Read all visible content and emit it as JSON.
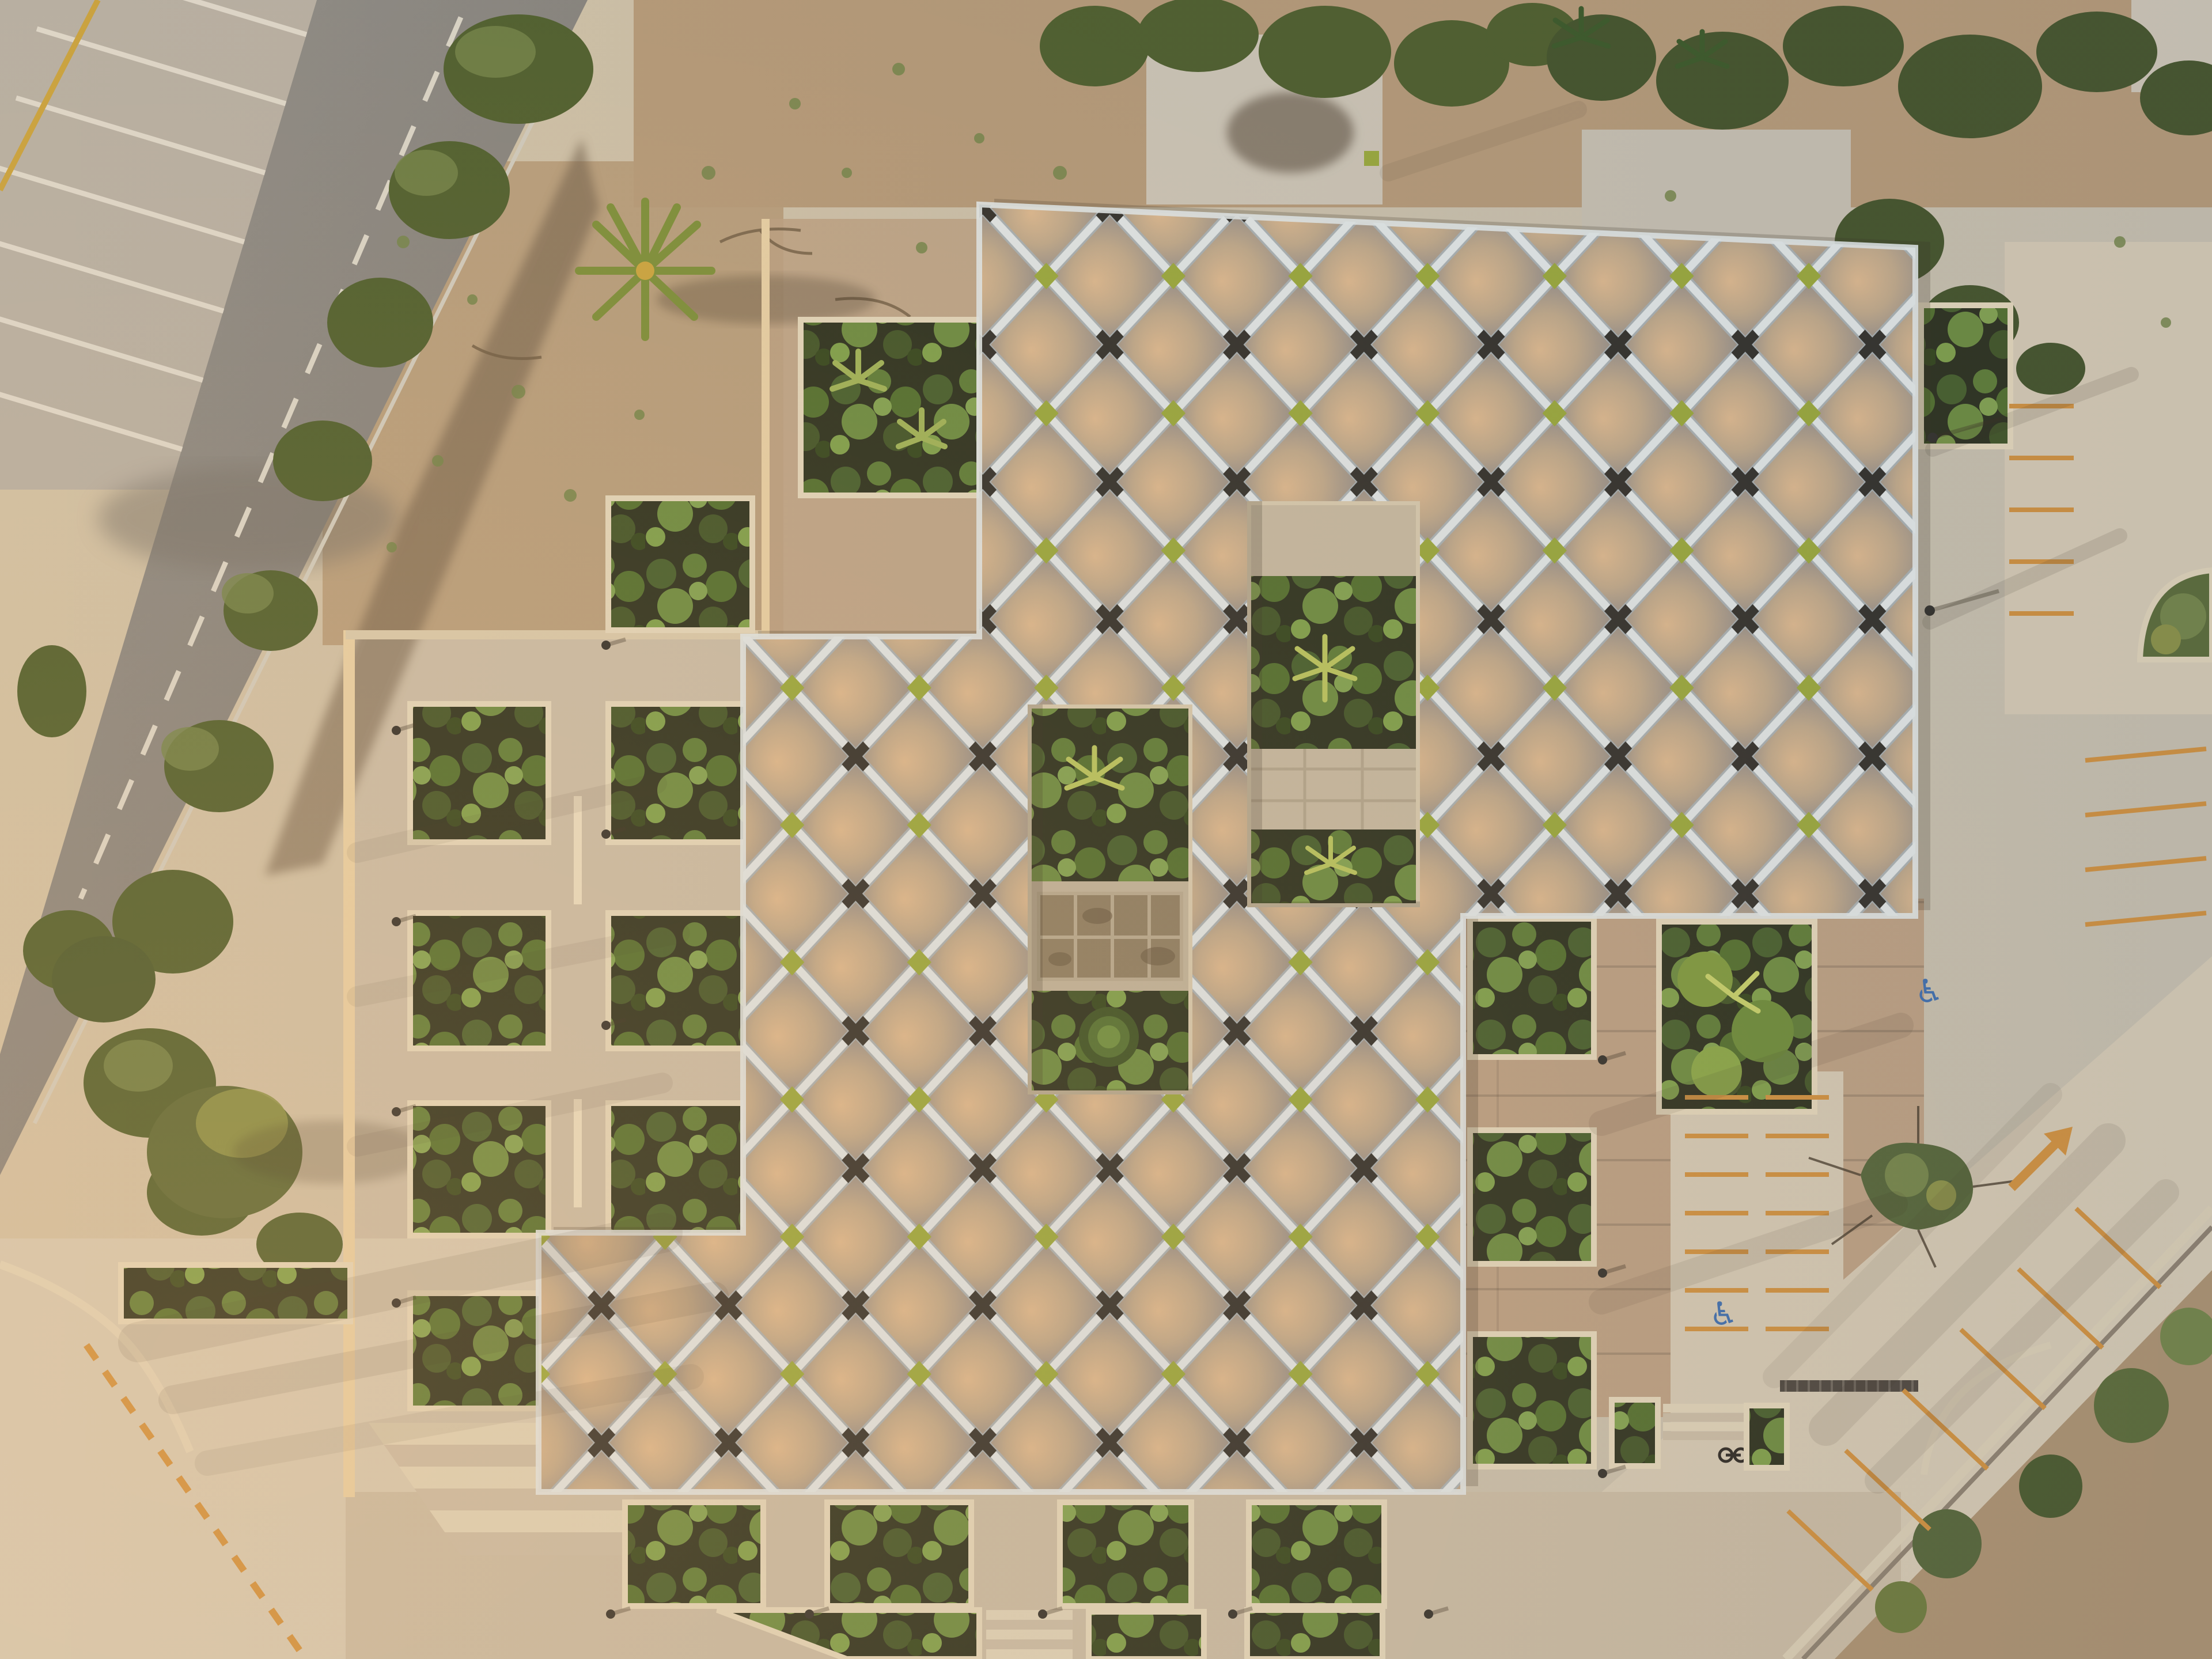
{
  "scene": {
    "type": "aerial-photograph",
    "time_of_day": "golden hour, low sun from west",
    "subject": "building with quilted diamond-grid fabric roof surrounded by courtyard gardens, planter-grid plazas, road and parking lots",
    "building": {
      "roof_blocks": 3,
      "courtyard_openings": 2,
      "roof_texture": "tufted pillow diamonds with pale ribs",
      "node_style": "dark X clips at alternating intersections",
      "accent_style": "olive-green diamond tiles at alternating intersections",
      "courtyard_1_contents": [
        "concrete strip",
        "garden plot",
        "paved band",
        "garden plot",
        "agave star plants"
      ],
      "courtyard_2_contents": [
        "garden plot",
        "weathered plaque tiles",
        "garden plot",
        "leaf rosette"
      ]
    },
    "site": {
      "left": [
        "striped angled parking bays",
        "asphalt road with dashed centerline",
        "roadside scrub and trees"
      ],
      "west_plaza": [
        "grid of square garden planters",
        "benches",
        "bollard lights",
        "sunlit retaining wall"
      ],
      "south": [
        "row of planters under roof edge",
        "wide stairs",
        "entrance steps",
        "triangular planter"
      ],
      "east": [
        "brick-paved terrace",
        "parking stalls",
        "heart-shaped planting island",
        "diagonal service road",
        "curved garden beds"
      ],
      "top": [
        "dirt ground",
        "scrub and palm trees",
        "old concrete slab pads"
      ]
    },
    "markings": {
      "accessible_symbol": "♿",
      "accessible_spaces": 2,
      "road_arrow_direction": "up-right",
      "stall_line_color_name": "orange",
      "bay_stripe_color_name": "white",
      "tactile_strip": "dashed orange line at bottom-left"
    }
  },
  "palette": {
    "roofBase": "#9b9288",
    "roofLit": "#dcb88e",
    "roofShade": "#8e8a85",
    "rib": "#e0e5e4",
    "ribEdge": "#a9b0b1",
    "node": "#35332d",
    "accent": "#9aa83d",
    "concrete": "#c9bca6",
    "concreteLight": "#d4c9b3",
    "concreteBright": "#ddd2b8",
    "brick": "#bba083",
    "dirt": "#b59a78",
    "soil": "#2e3320",
    "scrub": "#50602f",
    "scrubLight": "#74854a",
    "asphalt": "#8b8881",
    "lineWhite": "#d9d4c6",
    "lineOrange": "#cf9140",
    "lineYellow": "#c9a23f",
    "blue": "#3f6fae",
    "shadow": "#3a3124",
    "rim": "#e2d6ba",
    "wallLit": "#e6cfa4"
  }
}
